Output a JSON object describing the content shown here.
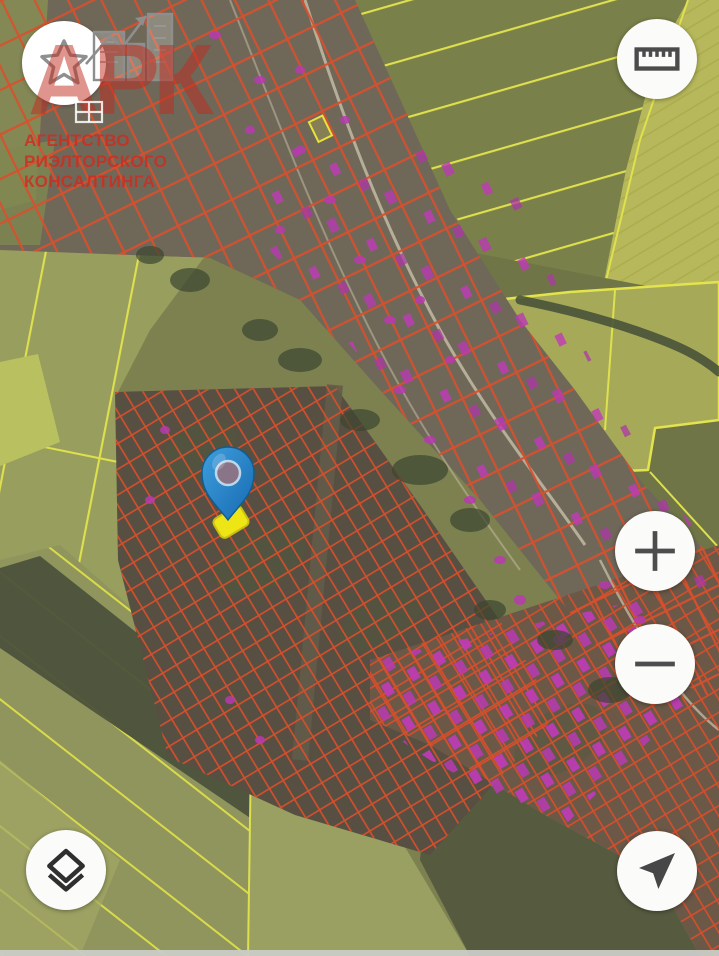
{
  "watermark": {
    "logo_text": "АРК",
    "lines": [
      "АГЕНТСТВО",
      "РИЭЛТОРСКОГО",
      "КОНСАЛТИНГА"
    ],
    "text_color": "#d7402e"
  },
  "controls": {
    "favorites": {
      "icon": "star-icon"
    },
    "measure": {
      "icon": "ruler-icon"
    },
    "zoom_in": {
      "icon": "plus-icon",
      "glyph": "+"
    },
    "zoom_out": {
      "icon": "minus-icon",
      "glyph": "−"
    },
    "layers": {
      "icon": "layers-icon"
    },
    "my_location": {
      "icon": "location-arrow-icon"
    }
  },
  "map": {
    "style": "satellite-cadastral",
    "marker": {
      "type": "pin",
      "pin_color": "#2088cd",
      "selected_parcel_color": "#f2ea15"
    },
    "overlays": {
      "cadastral_line_color": "#da4f2c",
      "highlighted_parcel_color": "#c13ab8",
      "field_boundary_color": "#dfe04e"
    }
  }
}
